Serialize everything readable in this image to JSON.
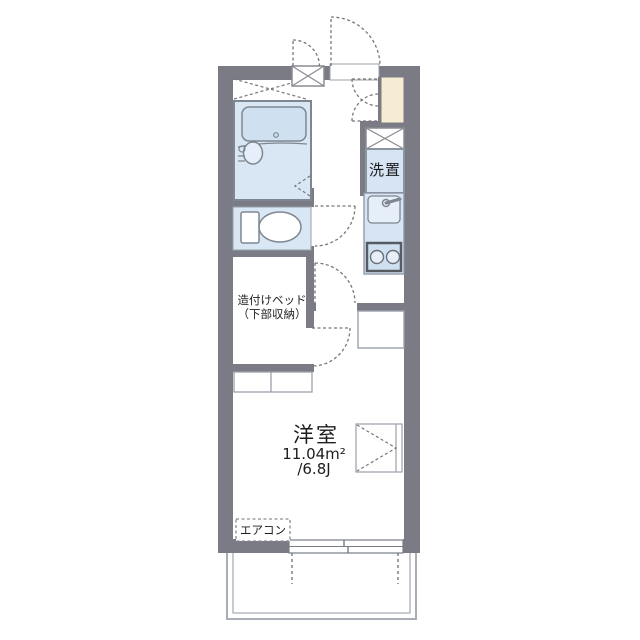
{
  "floorplan": {
    "rooms": {
      "western_room": {
        "name": "洋室",
        "area_m2": "11.04m²",
        "area_jo": "/6.8J"
      },
      "built_in_bed": {
        "label_line1": "造付けベッド",
        "label_line2": "（下部収納）"
      },
      "washer_space": {
        "label": "洗置"
      },
      "aircon": {
        "label": "エアコン"
      }
    },
    "colors": {
      "wall": "#7b7b85",
      "unit_blue": "#d9e6f4",
      "fixture_blue": "#cfe0f1",
      "kitchen_blue": "#d6e4f3",
      "sink_blue": "#e6eff9",
      "genkan_cream": "#f6ecd4",
      "line_gray": "#7e8791",
      "thin_gray": "#98a0ac",
      "door_dash": "#777777",
      "balcony_line": "#a9aeb6"
    }
  }
}
